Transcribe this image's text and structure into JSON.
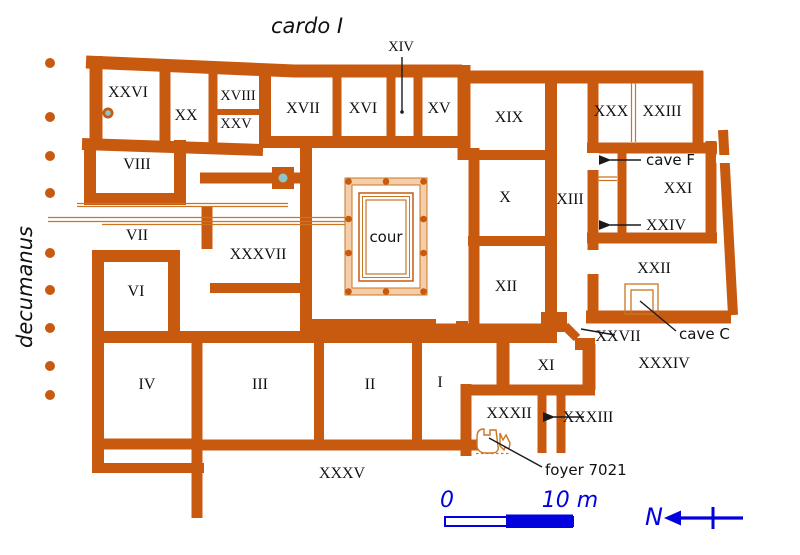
{
  "streets": {
    "cardo": "cardo I",
    "decumanus": "decumanus"
  },
  "rooms": {
    "i": "I",
    "ii": "II",
    "iii": "III",
    "iv": "IV",
    "vi": "VI",
    "vii": "VII",
    "viii": "VIII",
    "x": "X",
    "xi": "XI",
    "xii": "XII",
    "xiii": "XIII",
    "xiv": "XIV",
    "xv": "XV",
    "xvi": "XVI",
    "xvii": "XVII",
    "xviii": "XVIII",
    "xix": "XIX",
    "xx": "XX",
    "xxi": "XXI",
    "xxii": "XXII",
    "xxiii": "XXIII",
    "xxiv": "XXIV",
    "xxv": "XXV",
    "xxvi": "XXVI",
    "xxvii": "XXVII",
    "xxx": "XXX",
    "xxxii": "XXXII",
    "xxxiii": "XXXIII",
    "xxxiv": "XXXIV",
    "xxxv": "XXXV",
    "xxxvii": "XXXVII"
  },
  "annotations": {
    "cour": "cour",
    "cave_f": "cave F",
    "cave_c": "cave C",
    "foyer": "foyer 7021"
  },
  "scalebar": {
    "zero": "0",
    "ten_m": "10 m"
  },
  "compass": {
    "north": "N"
  },
  "colors": {
    "wall": "#C85A10",
    "thin": "#C97524",
    "band": "#F5CDA9",
    "blue": "#0202DE",
    "teal": "#8CC6CA",
    "text": "#111111"
  }
}
